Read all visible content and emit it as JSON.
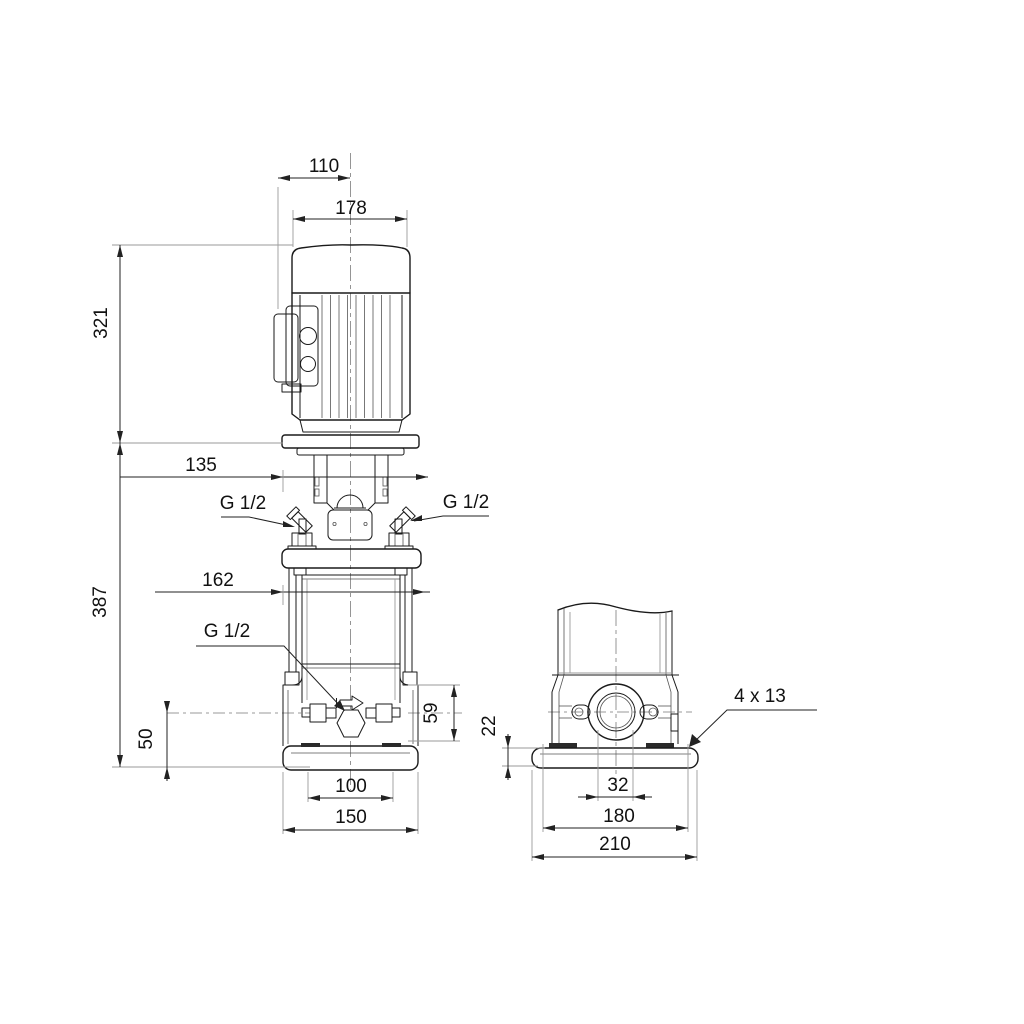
{
  "meta": {
    "drawing_type": "pump dimensional drawing",
    "background_color": "#ffffff",
    "line_color": "#1a1a1a",
    "views": 2
  },
  "labels": {
    "front": {
      "dim_motor_top_width": "110",
      "dim_motor_width": "178",
      "dim_motor_height": "321",
      "dim_stool_width": "135",
      "dim_pump_height": "387",
      "dim_head_flange_width": "162",
      "gauge_port_left": "G 1/2",
      "gauge_port_right": "G 1/2",
      "drain_port": "G 1/2",
      "dim_port_section_height": "59",
      "dim_port_centerline_height": "50",
      "dim_foot_bolt_spacing": "100",
      "dim_foot_width": "150"
    },
    "side": {
      "dim_base_thickness": "22",
      "dim_port_bore": "32",
      "dim_base_bolt_spacing": "180",
      "dim_base_length": "210",
      "dim_bolt_holes": "4 x 13"
    }
  }
}
